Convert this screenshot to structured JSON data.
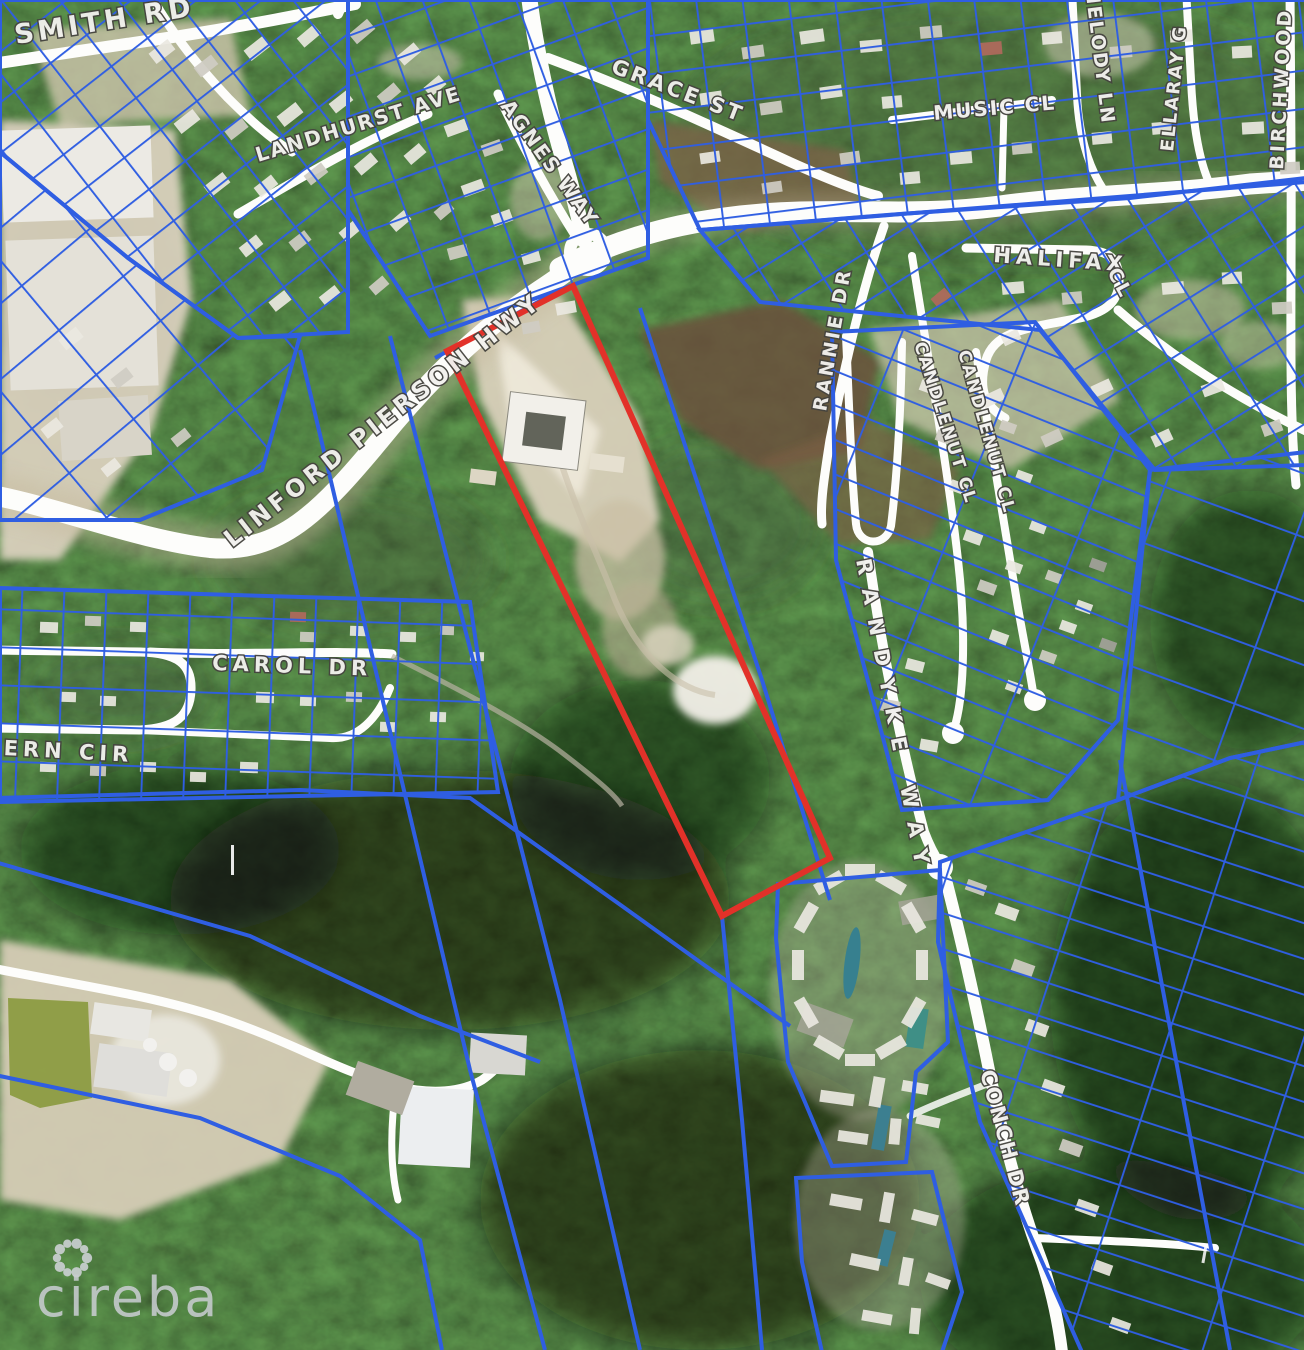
{
  "map": {
    "type": "satellite-cadastral-map",
    "attribution_logo": "cireba",
    "colors": {
      "parcel_line": "#2f5ee2",
      "highlight_parcel": "#e23129",
      "road": "#fdfdfb",
      "label_fill": "#f2f1ee",
      "label_outline": "#45443f"
    },
    "highlight_parcel": {
      "points": "447,351 573,286 830,858 722,916"
    },
    "street_labels": [
      {
        "text": "SMITH RD",
        "x": 16,
        "y": 44,
        "rot": -9,
        "size": 27,
        "ls": 4
      },
      {
        "text": "LANDHURST AVE",
        "x": 258,
        "y": 162,
        "rot": -17,
        "size": 20,
        "ls": 2
      },
      {
        "text": "AGNES WAY",
        "x": 500,
        "y": 106,
        "rot": 54,
        "size": 20,
        "ls": 2
      },
      {
        "text": "GRACE ST",
        "x": 610,
        "y": 72,
        "rot": 21,
        "size": 21,
        "ls": 3
      },
      {
        "text": "MUSIC CL",
        "x": 934,
        "y": 120,
        "rot": -5,
        "size": 20,
        "ls": 2
      },
      {
        "text": "MELODY LN",
        "x": 1085,
        "y": -14,
        "rot": 83,
        "size": 19,
        "ls": 2
      },
      {
        "text": "ELLARAY G",
        "x": 1173,
        "y": 152,
        "rot": -84,
        "size": 18,
        "ls": 2
      },
      {
        "text": "BIRCHWOOD",
        "x": 1283,
        "y": 170,
        "rot": -87,
        "size": 19,
        "ls": 3
      },
      {
        "text": "HALIFAX",
        "x": 993,
        "y": 262,
        "rot": 4,
        "size": 21,
        "ls": 5
      },
      {
        "text": "CL",
        "x": 1107,
        "y": 272,
        "rot": 62,
        "size": 19,
        "ls": 3
      },
      {
        "text": "LINFORD PIERSON HWY",
        "x": 232,
        "y": 548,
        "rot": -38,
        "size": 24,
        "ls": 4,
        "path": true
      },
      {
        "text": "RANNIE DR",
        "x": 826,
        "y": 412,
        "rot": -80,
        "size": 19,
        "ls": 3
      },
      {
        "text": "CANDLENUT CL",
        "x": 914,
        "y": 344,
        "rot": 72,
        "size": 17,
        "ls": 2
      },
      {
        "text": "CANDLENUT CL",
        "x": 958,
        "y": 352,
        "rot": 74,
        "size": 17,
        "ls": 2
      },
      {
        "text": "RANDYKE WAY",
        "x": 856,
        "y": 560,
        "rot": 79,
        "size": 21,
        "ls": 14
      },
      {
        "text": "CAROL DR",
        "x": 212,
        "y": 670,
        "rot": 2,
        "size": 21,
        "ls": 5
      },
      {
        "text": "FERN CIR",
        "x": -16,
        "y": 754,
        "rot": 3,
        "size": 21,
        "ls": 5
      },
      {
        "text": "CONCH DR",
        "x": 980,
        "y": 1072,
        "rot": 75,
        "size": 21,
        "ls": 2
      }
    ]
  }
}
